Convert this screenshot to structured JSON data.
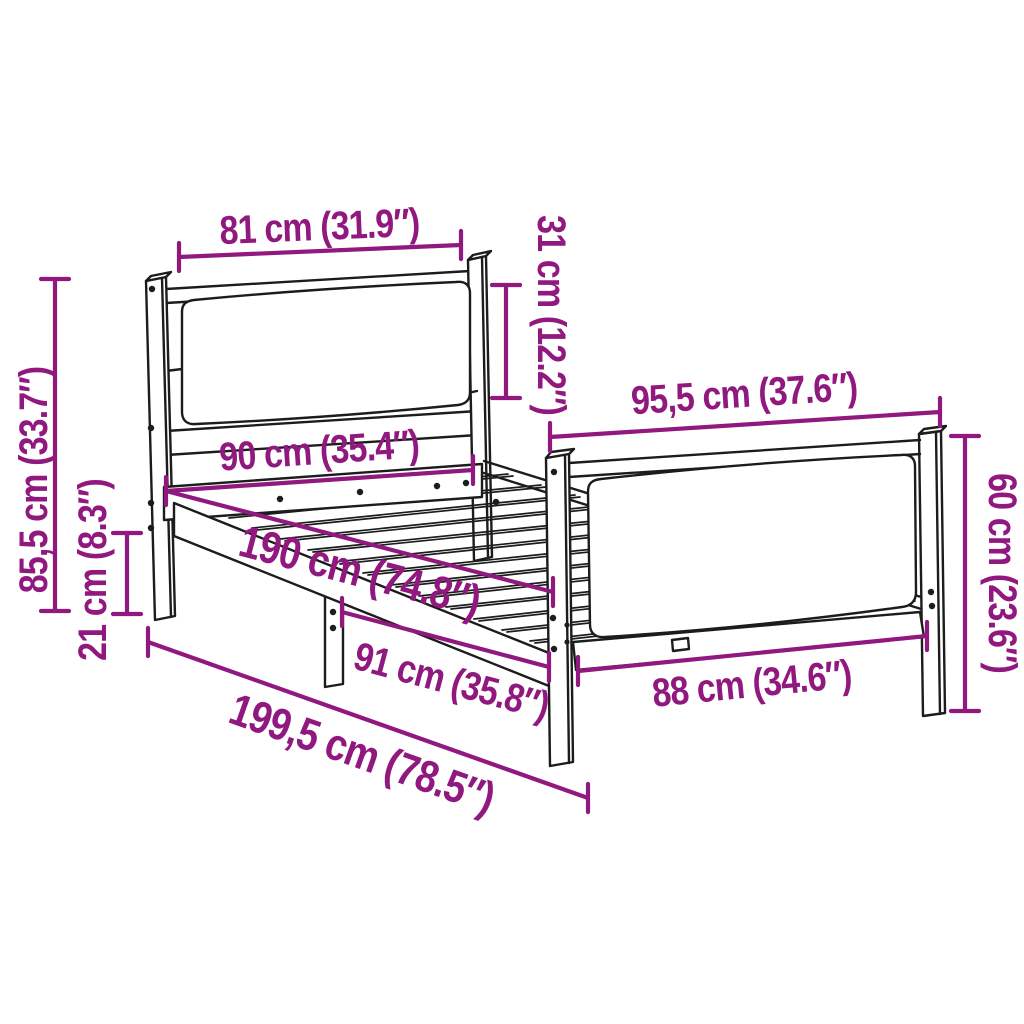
{
  "diagram": {
    "type": "product-dimension-diagram",
    "subject": "bed-frame-with-headboard-and-footboard",
    "units": [
      "cm",
      "inches"
    ],
    "colors": {
      "accent": "#90187E",
      "line": "#1c1c1c",
      "bg": "#ffffff"
    },
    "dimensions": [
      {
        "id": "headboard-width",
        "label": "81 cm (31.9″)",
        "cm": "81",
        "inches": "31.9"
      },
      {
        "id": "headboard-panel-height",
        "label": "31 cm (12.2″)",
        "cm": "31",
        "inches": "12.2"
      },
      {
        "id": "headboard-height",
        "label": "85,5 cm (33.7″)",
        "cm": "85,5",
        "inches": "33.7"
      },
      {
        "id": "under-bed-clearance",
        "label": "21 cm (8.3″)",
        "cm": "21",
        "inches": "8.3"
      },
      {
        "id": "bed-width",
        "label": "90 cm (35.4″)",
        "cm": "90",
        "inches": "35.4"
      },
      {
        "id": "bed-length",
        "label": "190 cm (74.8″)",
        "cm": "190",
        "inches": "74.8"
      },
      {
        "id": "footboard-width",
        "label": "95,5 cm (37.6″)",
        "cm": "95,5",
        "inches": "37.6"
      },
      {
        "id": "footboard-height",
        "label": "60 cm (23.6″)",
        "cm": "60",
        "inches": "23.6"
      },
      {
        "id": "footboard-inner-width",
        "label": "88 cm (34.6″)",
        "cm": "88",
        "inches": "34.6"
      },
      {
        "id": "side-section-length",
        "label": "91 cm (35.8″)",
        "cm": "91",
        "inches": "35.8"
      },
      {
        "id": "total-length",
        "label": "199,5 cm (78.5″)",
        "cm": "199,5",
        "inches": "78.5"
      }
    ]
  }
}
